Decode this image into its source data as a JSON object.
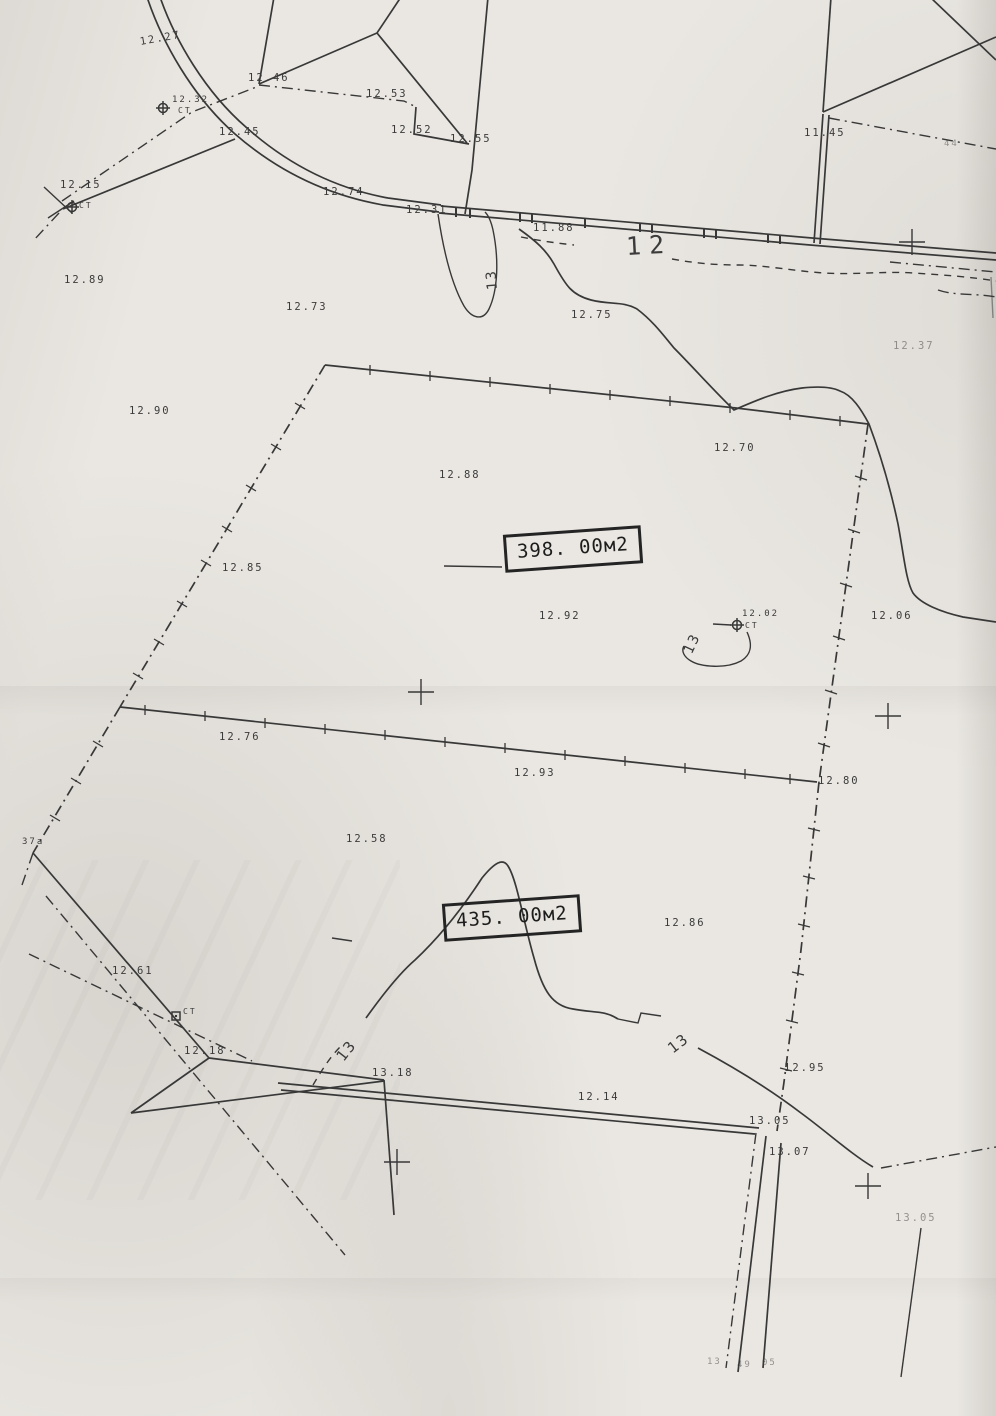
{
  "paper": {
    "background": "#eae7e2",
    "ink": "#383838"
  },
  "parcel_boxes": [
    {
      "label": "398. 00м2"
    },
    {
      "label": "435. 00м2"
    }
  ],
  "labels": [
    {
      "t": "12.27",
      "x": 140,
      "y": 37,
      "r": -10
    },
    {
      "t": "12.46",
      "x": 248,
      "y": 73
    },
    {
      "t": "12.53",
      "x": 366,
      "y": 89
    },
    {
      "t": "12.32",
      "x": 172,
      "y": 96,
      "s": 9
    },
    {
      "t": "CT",
      "x": 178,
      "y": 107,
      "s": 8
    },
    {
      "t": "12.45",
      "x": 219,
      "y": 127
    },
    {
      "t": "12.52",
      "x": 391,
      "y": 125
    },
    {
      "t": "12.55",
      "x": 450,
      "y": 134
    },
    {
      "t": "11.45",
      "x": 804,
      "y": 128
    },
    {
      "t": "12.15",
      "x": 60,
      "y": 180
    },
    {
      "t": "CT",
      "x": 79,
      "y": 202,
      "s": 8
    },
    {
      "t": "12.74",
      "x": 323,
      "y": 187
    },
    {
      "t": "12.31",
      "x": 406,
      "y": 205
    },
    {
      "t": "11.88",
      "x": 533,
      "y": 223
    },
    {
      "t": "12",
      "x": 626,
      "y": 234,
      "s": 25,
      "r": -3,
      "sp": 8
    },
    {
      "t": "12.89",
      "x": 64,
      "y": 275
    },
    {
      "t": "13",
      "x": 493,
      "y": 283,
      "s": 14,
      "r": -95
    },
    {
      "t": "12.73",
      "x": 286,
      "y": 302
    },
    {
      "t": "12.75",
      "x": 571,
      "y": 310
    },
    {
      "t": "12.37",
      "x": 893,
      "y": 341,
      "d": true
    },
    {
      "t": "12.90",
      "x": 129,
      "y": 406
    },
    {
      "t": "12.70",
      "x": 714,
      "y": 443
    },
    {
      "t": "12.88",
      "x": 439,
      "y": 470
    },
    {
      "t": "12.85",
      "x": 222,
      "y": 563
    },
    {
      "t": "12.92",
      "x": 539,
      "y": 611
    },
    {
      "t": "12.02",
      "x": 742,
      "y": 610,
      "s": 9
    },
    {
      "t": "CT",
      "x": 745,
      "y": 622,
      "s": 8
    },
    {
      "t": "13",
      "x": 688,
      "y": 646,
      "s": 14,
      "r": -65
    },
    {
      "t": "12.06",
      "x": 871,
      "y": 611
    },
    {
      "t": "12.76",
      "x": 219,
      "y": 732
    },
    {
      "t": "12.93",
      "x": 514,
      "y": 768
    },
    {
      "t": "12.80",
      "x": 818,
      "y": 776
    },
    {
      "t": "12.58",
      "x": 346,
      "y": 834
    },
    {
      "t": "37a",
      "x": 22,
      "y": 838,
      "s": 9
    },
    {
      "t": "12.86",
      "x": 664,
      "y": 918
    },
    {
      "t": "12.61",
      "x": 112,
      "y": 966
    },
    {
      "t": "CT",
      "x": 183,
      "y": 1008,
      "s": 8
    },
    {
      "t": "12.18",
      "x": 184,
      "y": 1046
    },
    {
      "t": "13",
      "x": 340,
      "y": 1052,
      "s": 15,
      "r": -52
    },
    {
      "t": "13.18",
      "x": 372,
      "y": 1068
    },
    {
      "t": "13",
      "x": 670,
      "y": 1043,
      "s": 15,
      "r": -38
    },
    {
      "t": "12.14",
      "x": 578,
      "y": 1092
    },
    {
      "t": "12.95",
      "x": 784,
      "y": 1063
    },
    {
      "t": "13.05",
      "x": 749,
      "y": 1116
    },
    {
      "t": "13.07",
      "x": 769,
      "y": 1147
    },
    {
      "t": "13.05",
      "x": 895,
      "y": 1213,
      "d": true
    },
    {
      "t": "13",
      "x": 707,
      "y": 1358,
      "s": 9,
      "d": true
    },
    {
      "t": "49",
      "x": 737,
      "y": 1361,
      "s": 9,
      "d": true
    },
    {
      "t": "05",
      "x": 762,
      "y": 1359,
      "s": 9,
      "d": true
    },
    {
      "t": "44",
      "x": 944,
      "y": 140,
      "s": 9,
      "d": true
    }
  ],
  "crosses": [
    {
      "x": 912,
      "y": 242
    },
    {
      "x": 421,
      "y": 692
    },
    {
      "x": 888,
      "y": 716
    },
    {
      "x": 397,
      "y": 1162
    },
    {
      "x": 868,
      "y": 1186
    }
  ],
  "stations": [
    {
      "x": 163,
      "y": 108,
      "kind": "circle"
    },
    {
      "x": 72,
      "y": 207,
      "kind": "circle"
    },
    {
      "x": 737,
      "y": 625,
      "kind": "circle"
    },
    {
      "x": 176,
      "y": 1016,
      "kind": "square"
    }
  ]
}
